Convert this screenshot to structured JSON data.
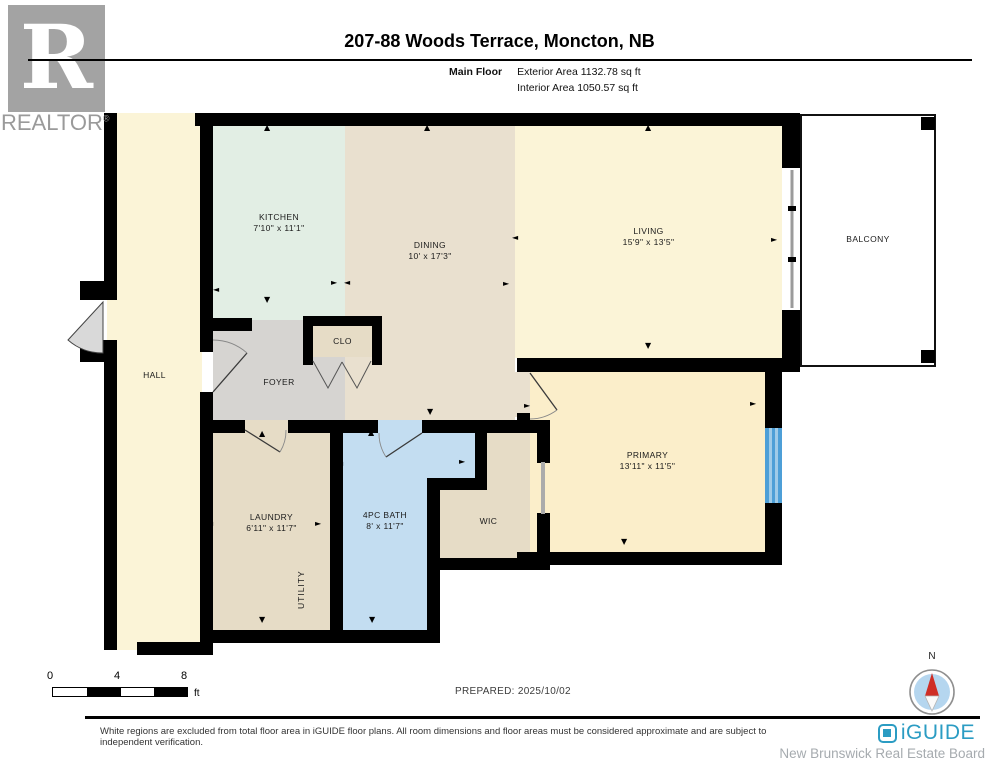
{
  "header": {
    "title": "207-88 Woods Terrace, Moncton, NB",
    "floor_label": "Main Floor",
    "exterior_area": "Exterior Area 1132.78 sq ft",
    "interior_area": "Interior Area 1050.57 sq ft"
  },
  "branding": {
    "realtor_letter": "R",
    "realtor_text": "REALTOR",
    "registered_mark": "®",
    "iguide_text": "iGUIDE",
    "board_text": "New Brunswick Real Estate Board"
  },
  "rooms": {
    "kitchen": {
      "name": "KITCHEN",
      "dims": "7'10\" x 11'1\""
    },
    "dining": {
      "name": "DINING",
      "dims": "10' x 17'3\""
    },
    "living": {
      "name": "LIVING",
      "dims": "15'9\" x 13'5\""
    },
    "balcony": {
      "name": "BALCONY"
    },
    "hall": {
      "name": "HALL"
    },
    "foyer": {
      "name": "FOYER"
    },
    "closet": {
      "name": "CLO"
    },
    "primary": {
      "name": "PRIMARY",
      "dims": "13'11\" x 11'5\""
    },
    "laundry": {
      "name": "LAUNDRY",
      "dims": "6'11\" x 11'7\""
    },
    "bath": {
      "name": "4PC BATH",
      "dims": "8' x 11'7\""
    },
    "wic": {
      "name": "WIC"
    },
    "utility": {
      "name": "UTILITY"
    }
  },
  "scale_bar": {
    "labels": [
      "0",
      "4",
      "8"
    ],
    "unit": "ft"
  },
  "prepared": "PREPARED: 2025/10/02",
  "compass": {
    "north_label": "N"
  },
  "footer": {
    "disclaimer": "White regions are excluded from total floor area in iGUIDE floor plans. All room dimensions and floor areas must be considered approximate and are subject to independent verification."
  },
  "icons": {
    "arrow_up": "▲",
    "arrow_down": "▼",
    "arrow_left": "◄",
    "arrow_right": "►"
  },
  "colors": {
    "wall": "#000000",
    "hall_living": "#fbf4d7",
    "kitchen": "#e2eee4",
    "dining": "#e9e0cf",
    "foyer": "#d6d4d1",
    "tan_rooms": "#e6dcc6",
    "bath": "#c3ddf1",
    "primary": "#fbeeca",
    "window_blue": "#4d9fd7",
    "iguide_teal": "#2b9cc3",
    "compass_red": "#cf2e26",
    "compass_blue": "#b5d6ef",
    "logo_gray": "#a3a3a3"
  }
}
